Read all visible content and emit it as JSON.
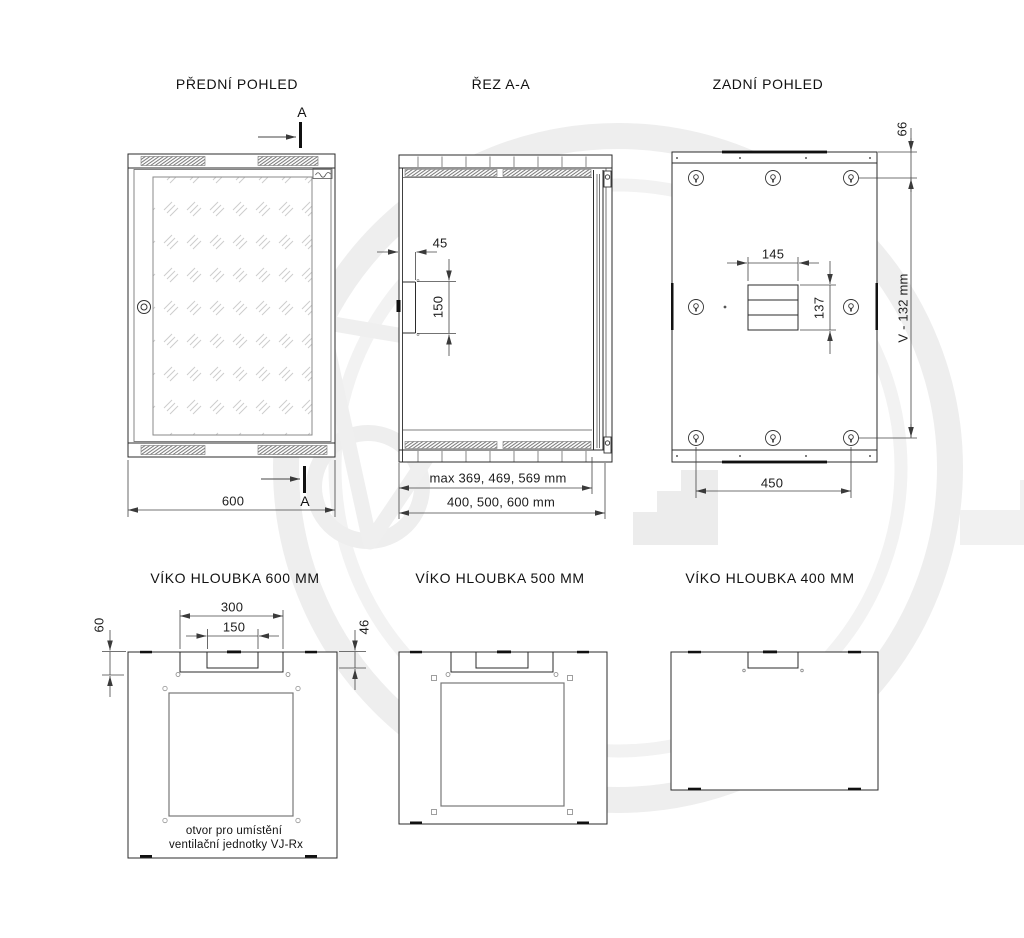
{
  "drawing": {
    "colors": {
      "background": "#ffffff",
      "line": "#2b2b2b",
      "dimension": "#444444",
      "watermark": "#eeeeee"
    },
    "views": {
      "front": {
        "title": "PŘEDNÍ POHLED",
        "section_label": "A",
        "dim_width": "600"
      },
      "section": {
        "title": "ŘEZ A-A",
        "dim_notch_depth": "45",
        "dim_notch_height": "150",
        "dim_inner_depth": "max 369, 469, 569 mm",
        "dim_outer_depth": "400, 500, 600 mm"
      },
      "rear": {
        "title": "ZADNÍ POHLED",
        "dim_edge_offset": "66",
        "dim_mount_height": "V - 132 mm",
        "dim_cutout_width": "145",
        "dim_cutout_height": "137",
        "dim_mount_spacing": "450"
      },
      "lid600": {
        "title": "VÍKO HLOUBKA 600 MM",
        "dim_outer_opening": "300",
        "dim_inner_opening": "150",
        "dim_left_offset": "60",
        "dim_right_offset": "46",
        "note_line1": "otvor pro umístění",
        "note_line2": "ventilační jednotky VJ-Rx"
      },
      "lid500": {
        "title": "VÍKO HLOUBKA 500 MM"
      },
      "lid400": {
        "title": "VÍKO HLOUBKA 400 MM"
      }
    }
  }
}
